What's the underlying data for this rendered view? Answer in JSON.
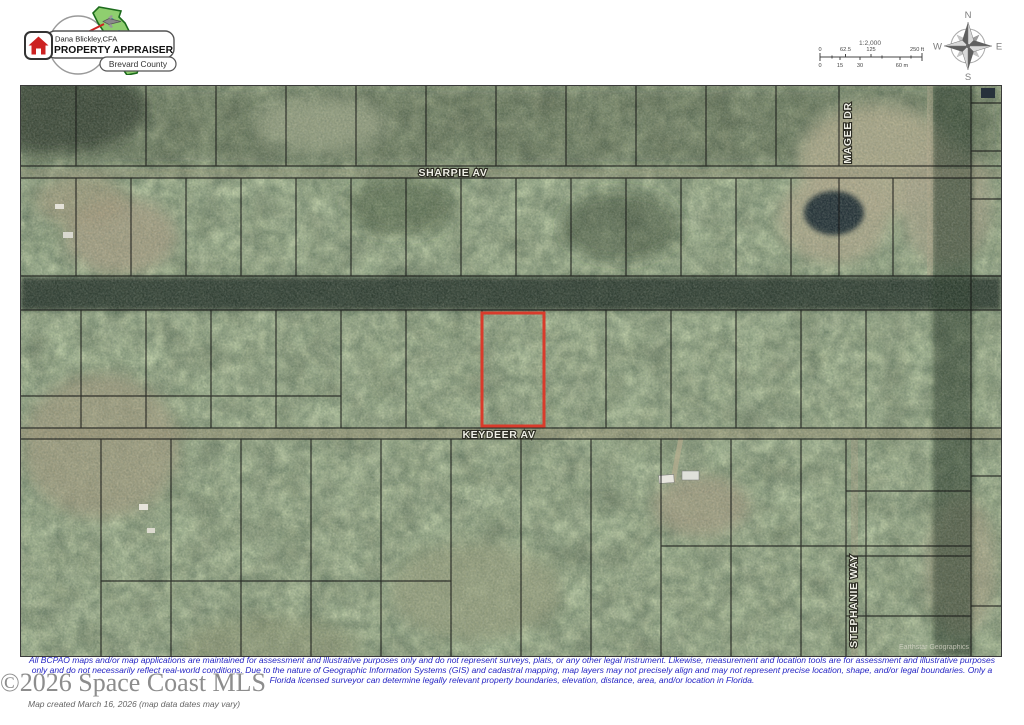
{
  "logo": {
    "name": "Dana Blickley,CFA",
    "title": "PROPERTY APPRAISER",
    "county": "Brevard County"
  },
  "scale": {
    "ratio": "1:2,000",
    "ft": [
      "0",
      "62.5",
      "125",
      "250 ft"
    ],
    "m": [
      "0",
      "15",
      "30",
      "60 m"
    ]
  },
  "compass": {
    "n": "N",
    "e": "E",
    "s": "S",
    "w": "W"
  },
  "map": {
    "streets": {
      "sharpie": "SHARPIE AV",
      "keydeer": "KEYDEER AV",
      "magee": "MAGEE DR",
      "stephanie": "STEPHANIE WAY"
    },
    "attribution": "Earthstar Geographics",
    "highlight_color": "#d93b2b"
  },
  "footer": {
    "line1": "All BCPAO maps and/or map applications are maintained for assessment and illustrative purposes only and do not represent surveys, plats, or any other legal instrument. Likewise, measurement and location tools are for assessment and illustrative purposes",
    "line2": "only and do not necessarily reflect real-world conditions. Due to the nature of Geographic Information Systems (GIS) and cadastral mapping, map layers may not precisely align and may not represent precise location, shape, and/or legal boundaries. Only a",
    "line3": "Florida licensed surveyor can determine legally relevant property boundaries, elevation, distance, area, and/or location in Florida.",
    "watermark": "©2026 Space Coast MLS",
    "created": "Map created March 16, 2026 (map data dates may vary)"
  }
}
